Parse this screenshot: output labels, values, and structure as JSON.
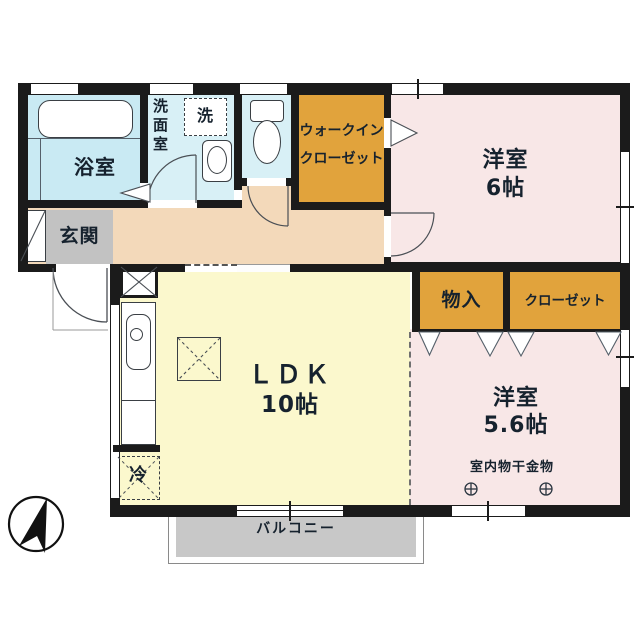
{
  "plan_type": "apartment-floorplan",
  "rooms": {
    "bath": {
      "label": "浴室"
    },
    "washroom": {
      "label": "洗面室",
      "washer_label": "洗"
    },
    "toilet": {
      "label": ""
    },
    "wic": {
      "label_line1": "ウォークイン",
      "label_line2": "クローゼット"
    },
    "bedroom6": {
      "label": "洋室",
      "size": "6帖"
    },
    "entrance": {
      "label": "玄関"
    },
    "ldk": {
      "label": "ＬＤＫ",
      "size": "10帖",
      "fridge_label": "冷"
    },
    "storage": {
      "label": "物入"
    },
    "closet": {
      "label": "クローゼット"
    },
    "bedroom56": {
      "label": "洋室",
      "size": "5.6帖",
      "hanger_label": "室内物干金物"
    },
    "balcony": {
      "label": "バルコニー"
    }
  },
  "icons": [
    "bathtub-icon",
    "washing-machine-icon",
    "sink-icon",
    "toilet-icon",
    "kitchen-counter-icon",
    "fridge-icon",
    "pipe-shaft-icon",
    "hatch-icon",
    "hanger-bolt-icon",
    "north-arrow-icon",
    "door-swing-icon",
    "folding-door-icon"
  ],
  "colors": {
    "wall": "#1b1b1b",
    "bath": "#c9eaf3",
    "washroom": "#d8f0f6",
    "toilet": "#d8f0f6",
    "orange": "#e1a33c",
    "pink": "#f8e7e7",
    "hallway": "#f3d9ba",
    "ldk": "#fbf8cd",
    "genkan": "#c2c2c2",
    "balcony": "#c8c8c8",
    "text": "#16222e"
  }
}
